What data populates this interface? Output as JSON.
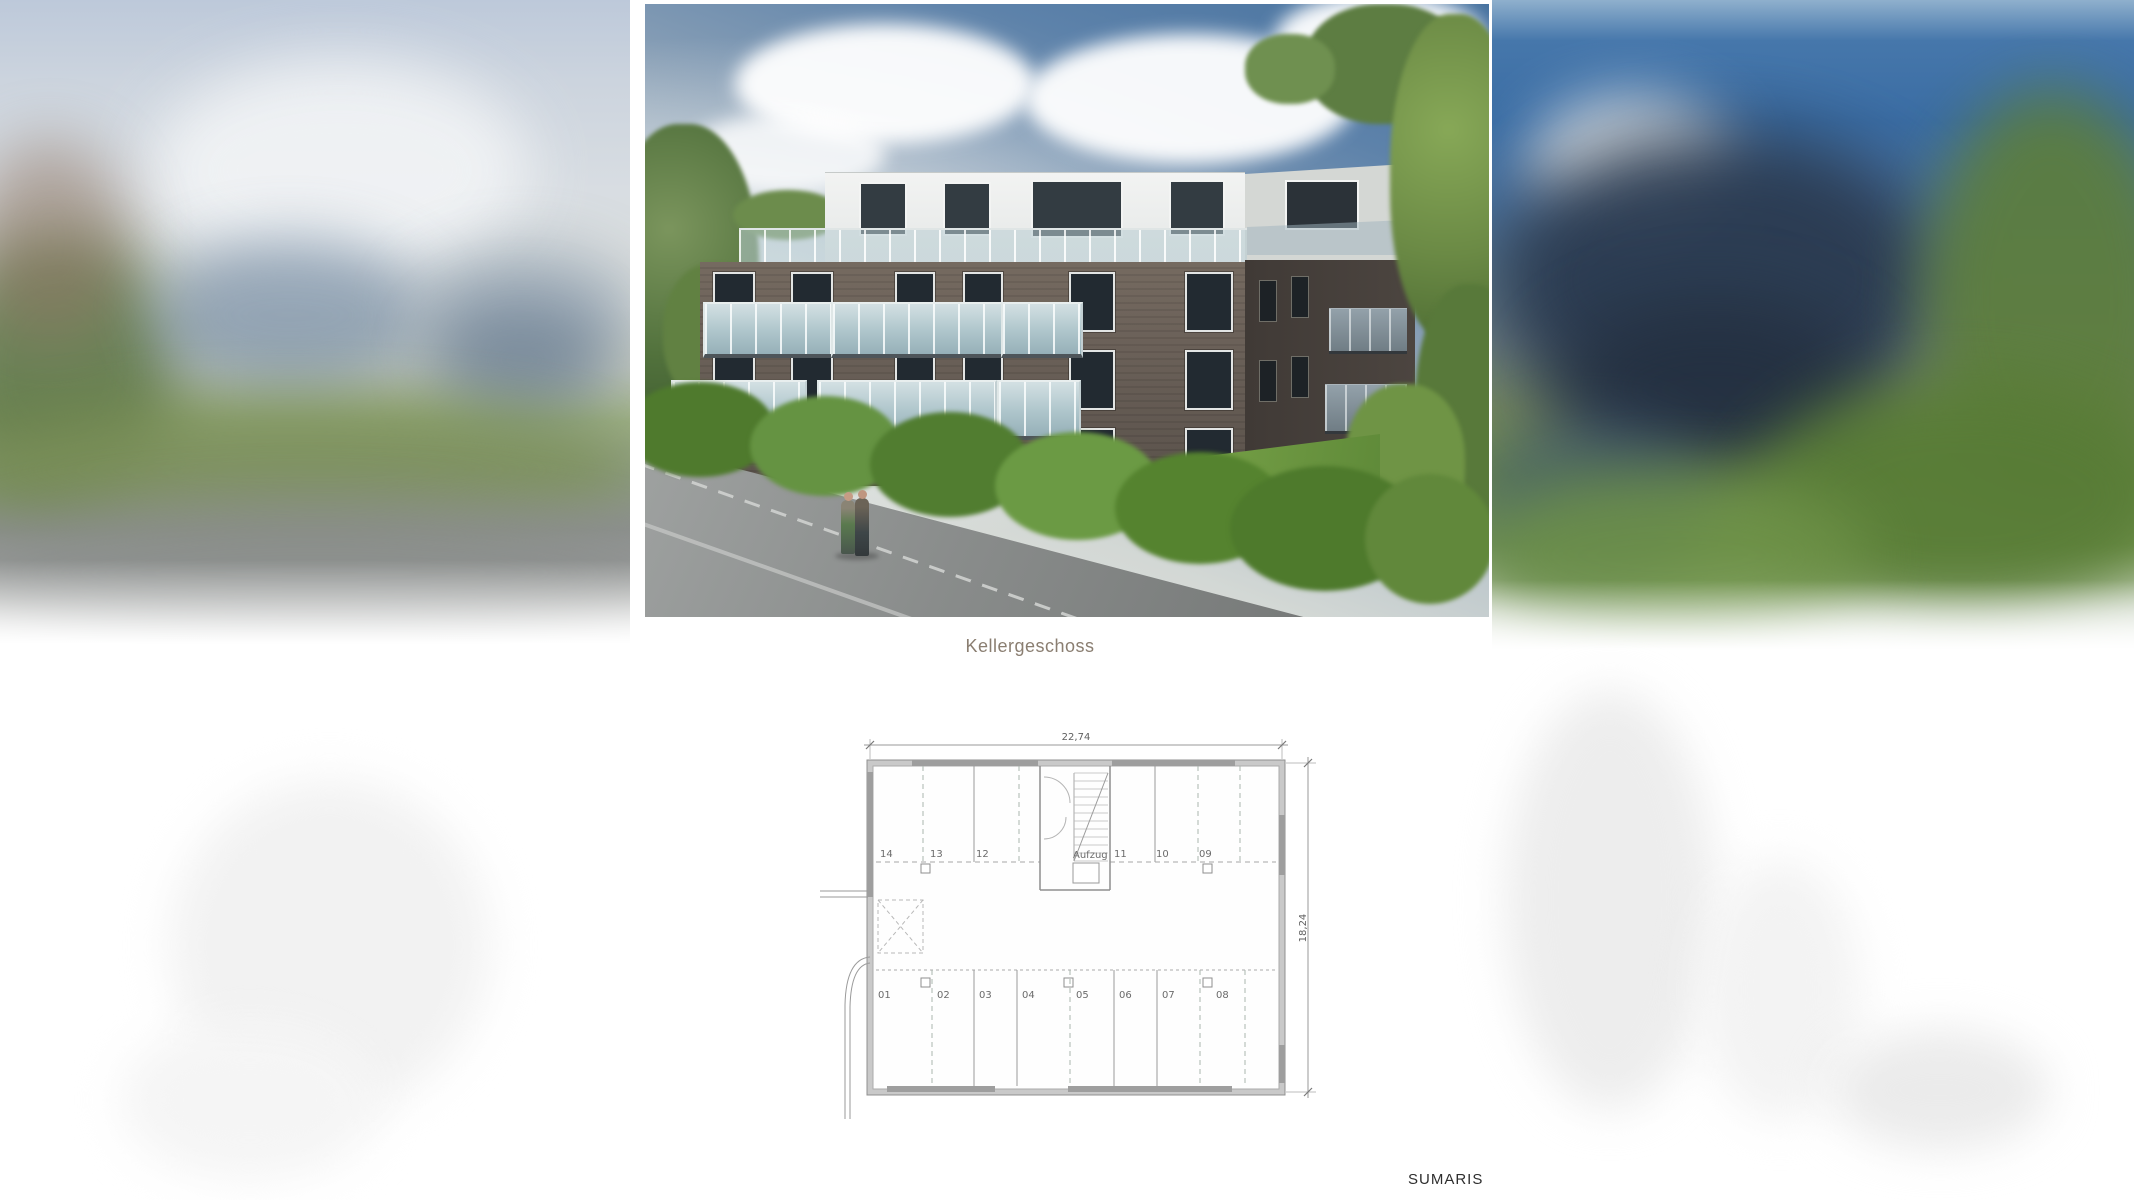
{
  "caption": "Kellergeschoss",
  "watermark": "SUMARIS",
  "photo": {
    "description": "3D architectural rendering of a modern three-storey apartment building with glass balconies, white penthouse floor, hedge, street and trees"
  },
  "floorplan": {
    "width_dim": "22,74",
    "height_dim": "18,24",
    "elevator": "Aufzug",
    "top_rooms": [
      "14",
      "13",
      "12",
      "11",
      "10",
      "09"
    ],
    "bottom_rooms": [
      "01",
      "02",
      "03",
      "04",
      "05",
      "06",
      "07",
      "08"
    ]
  },
  "colors": {
    "sky_deep_blue": "#4a75a2",
    "facade_brick": "#6a6058",
    "balcony_glass": "#aec5cb",
    "hedge_green": "#55832f",
    "plan_line_gray": "#909090",
    "caption_text": "#8a7e71"
  }
}
